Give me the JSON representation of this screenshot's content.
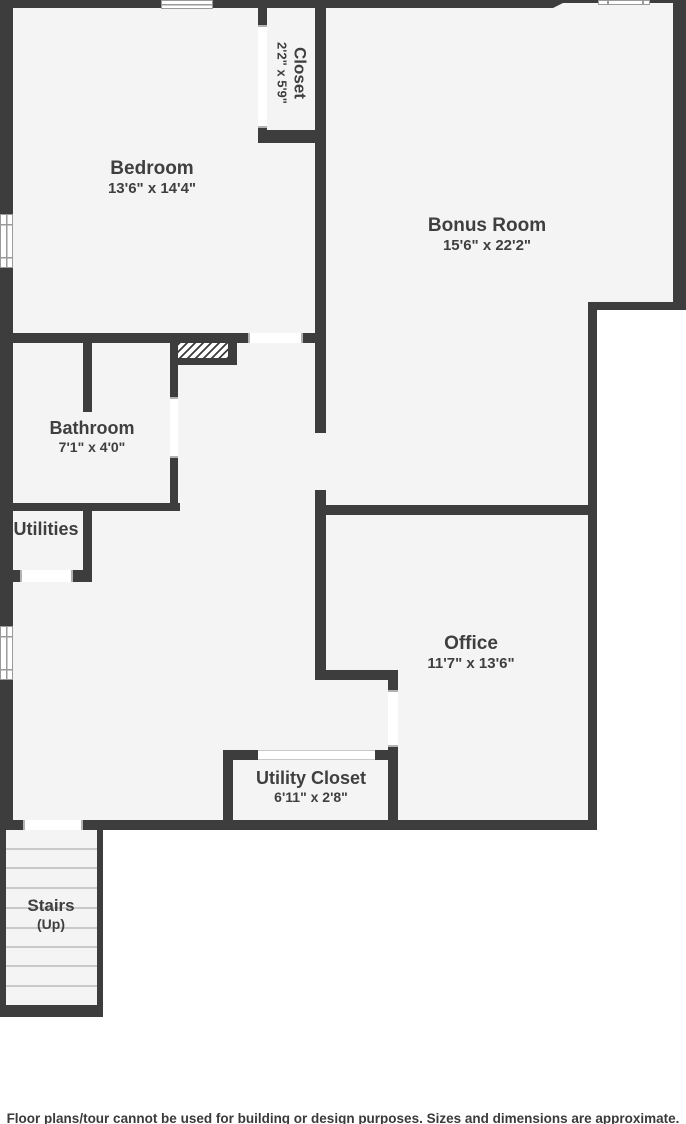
{
  "rooms": {
    "bedroom": {
      "name": "Bedroom",
      "dims": "13'6\" x 14'4\""
    },
    "closet": {
      "name": "Closet",
      "dims": "2'2\" x 5'9\""
    },
    "bonus_room": {
      "name": "Bonus Room",
      "dims": "15'6\" x 22'2\""
    },
    "bathroom": {
      "name": "Bathroom",
      "dims": "7'1\" x 4'0\""
    },
    "utilities": {
      "name": "Utilities"
    },
    "office": {
      "name": "Office",
      "dims": "11'7\" x 13'6\""
    },
    "utility_closet": {
      "name": "Utility Closet",
      "dims": "6'11\" x 2'8\""
    },
    "stairs": {
      "name": "Stairs",
      "dims": "(Up)"
    }
  },
  "footer": {
    "disclaimer": "Floor plans/tour cannot be used for building or design purposes. Sizes and dimensions are approximate."
  },
  "colors": {
    "wall": "#3d3d3d",
    "floor": "#f4f4f4",
    "text": "#3f3f3f",
    "outside": "#ffffff"
  }
}
